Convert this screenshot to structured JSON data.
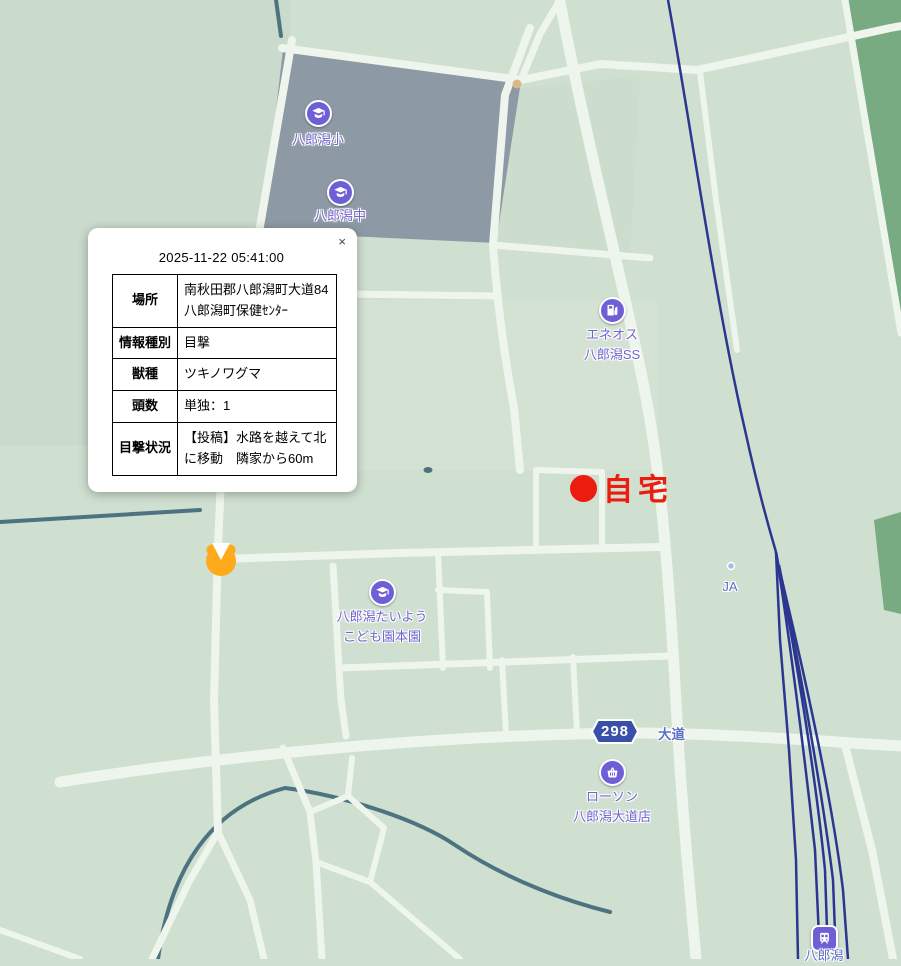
{
  "popup": {
    "close_label": "×",
    "datetime": "2025-11-22 05:41:00",
    "rows": [
      {
        "label": "場所",
        "value": "南秋田郡八郎潟町大道84八郎潟町保健ｾﾝﾀｰ"
      },
      {
        "label": "情報種別",
        "value": "目撃"
      },
      {
        "label": "獣種",
        "value": "ツキノワグマ"
      },
      {
        "label": "頭数",
        "value": "単独：1"
      },
      {
        "label": "目撃状況",
        "value": "【投稿】水路を越えて北に移動　隣家から60m"
      }
    ]
  },
  "map": {
    "pois": {
      "elementary": {
        "label": "八郎潟小"
      },
      "junior_high": {
        "label": "八郎潟中"
      },
      "gas": {
        "line1": "エネオス",
        "line2": "八郎潟SS"
      },
      "kindergarten": {
        "line1": "八郎潟たいよう",
        "line2": "こども園本園"
      },
      "lawson": {
        "line1": "ローソン",
        "line2": "八郎潟大道店"
      },
      "station": {
        "label": "八郎潟"
      },
      "ja": {
        "label": "JA"
      }
    },
    "roads": {
      "route_number": "298",
      "road_name": "大道"
    },
    "home": {
      "label": "自宅"
    },
    "colors": {
      "base_green": "#cfdfd0",
      "block_gray_green": "#c7d6c9",
      "block_light_green": "#d7e5d6",
      "road_white": "#eef5ec",
      "school_zone_gray": "#8d99a4",
      "forest_green": "#78ab81",
      "water_teal": "#4d7280",
      "railway_navy": "#2b3691",
      "marker_purple": "#6e5fd6",
      "label_purple": "#7163cf",
      "label_blue": "#5c6fc5",
      "route_shield_blue": "#3a50a8",
      "home_red": "#ec1c0e",
      "sighting_orange": "#ffaa1d"
    }
  }
}
